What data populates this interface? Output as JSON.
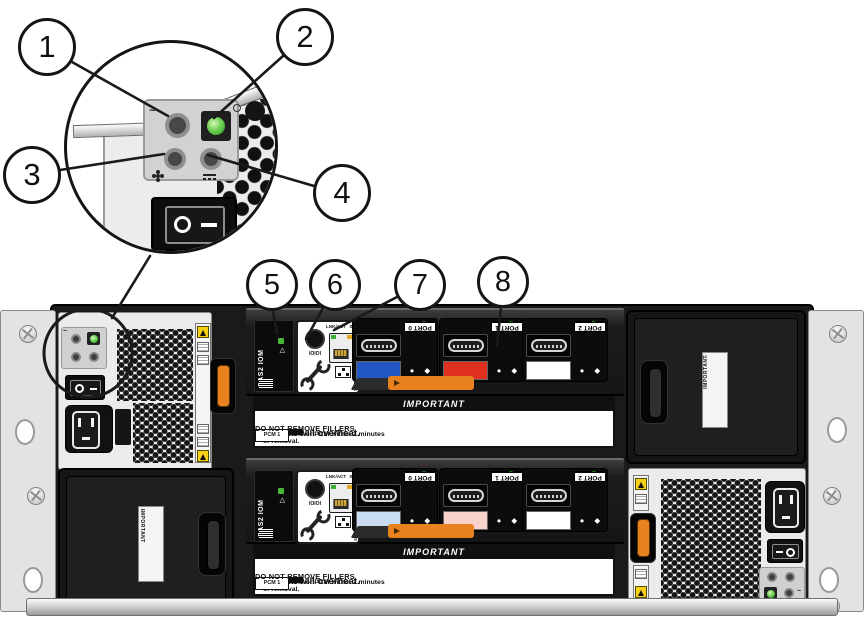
{
  "figure": {
    "description_type": "hardware-rear-view-diagram"
  },
  "callouts": [
    "1",
    "2",
    "3",
    "4",
    "5",
    "6",
    "7",
    "8"
  ],
  "psu": {
    "ac_glyph": "~",
    "switch_glyph_circle": "O",
    "switch_glyph_dash": "—"
  },
  "iom": {
    "module_label": "SAS2 IOM",
    "serial_label": "IOIOI",
    "eth_lnk": "LNK/ACT",
    "eth_spd": "Spd",
    "service_only": "SERVICE ONLY",
    "led_numbers": "1 2 3 4",
    "status_dots": "● ◆",
    "fault_triangle": "△",
    "ports": [
      {
        "label": "PORT 0"
      },
      {
        "label": "PORT 1"
      },
      {
        "label": "PORT 2"
      }
    ],
    "top_tab_colors": [
      "#2257c4",
      "#df2f1e",
      "#ffffff"
    ],
    "bottom_tab_colors": [
      "#c9dcf2",
      "#f8d2cb",
      "#ffffff"
    ]
  },
  "important_label": {
    "title": "IMPORTANT",
    "heading": "System will overheat.",
    "body": "Replace IOM or PCM within 2 minutes of removal.",
    "note": "DO NOT REMOVE FILLERS",
    "grid": {
      "r1c1": "PCM 2",
      "r1c2a": "IOM 1",
      "r1c2b": "FILLER",
      "r1c3": "FILLER 3",
      "r2c1": "FILLER 0",
      "r2c2a": "IOM 0",
      "r2c2b": "FILLER",
      "r2c3": "PCM 1"
    }
  },
  "filler": {
    "side_label": "IMPORTANT"
  },
  "colors": {
    "latch_orange": "#e8821e",
    "led_green": "#4cb83e",
    "chassis_dark": "#1a1a1a",
    "psu_body": "#ebebeb"
  }
}
